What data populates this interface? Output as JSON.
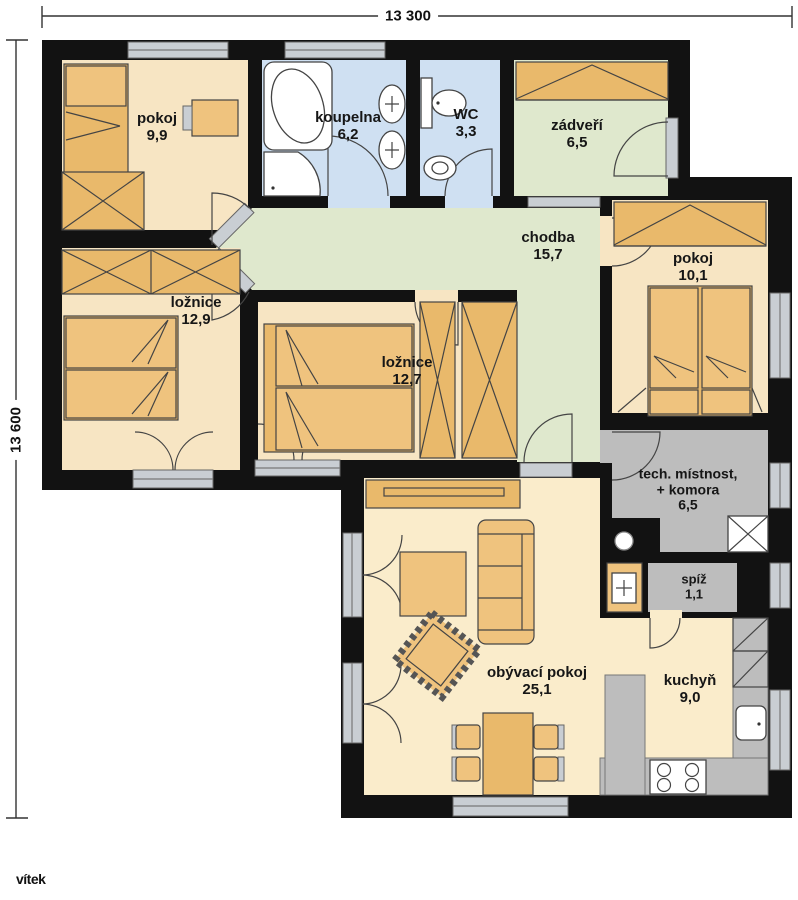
{
  "title": "bungalow floor plan",
  "dimensions": {
    "width_label": "13 300",
    "height_label": "13 600"
  },
  "watermark": "vítek",
  "rooms": {
    "pokoj1": {
      "name": "pokoj",
      "area": "9,9"
    },
    "koupelna": {
      "name": "koupelna",
      "area": "6,2"
    },
    "wc": {
      "name": "WC",
      "area": "3,3"
    },
    "zadveri": {
      "name": "zádveří",
      "area": "6,5"
    },
    "chodba": {
      "name": "chodba",
      "area": "15,7"
    },
    "pokoj2": {
      "name": "pokoj",
      "area": "10,1"
    },
    "loznice1": {
      "name": "ložnice",
      "area": "12,9"
    },
    "loznice2": {
      "name": "ložnice",
      "area": "12,7"
    },
    "tech": {
      "name": "tech. místnost,",
      "name2": "+ komora",
      "area": "6,5"
    },
    "spiz": {
      "name": "spíž",
      "area": "1,1"
    },
    "obyvaci": {
      "name": "obývací pokoj",
      "area": "25,1"
    },
    "kuchyn": {
      "name": "kuchyň",
      "area": "9,0"
    }
  },
  "colors": {
    "wall": "#121212",
    "floor_room": "#f7e5c3",
    "floor_living": "#faeccb",
    "floor_bath": "#cfe0f2",
    "floor_hall": "#dfe8cd",
    "floor_utility": "#bdbdbd",
    "furniture": "#efc37e",
    "furniture_dark": "#e9b96b",
    "window": "#c9ced3",
    "fixture": "#ffffff",
    "line": "#444444"
  }
}
